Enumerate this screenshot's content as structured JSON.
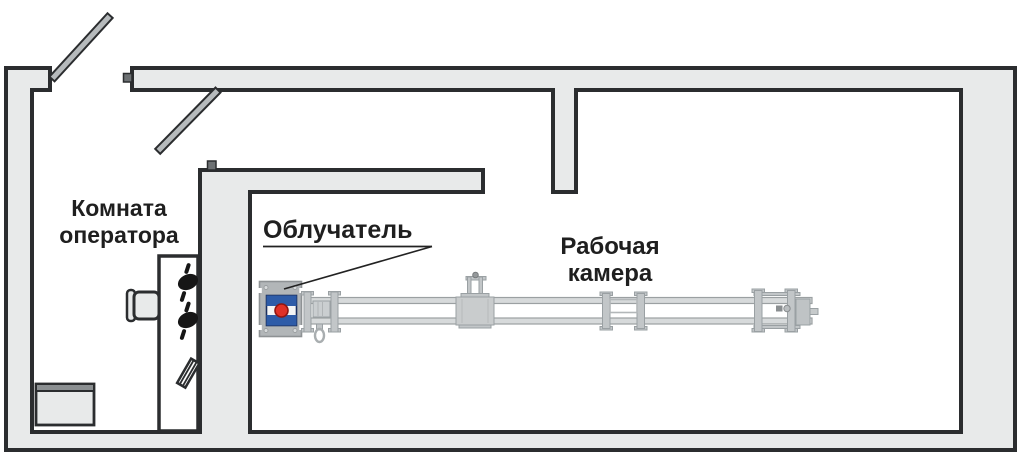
{
  "floor_plan": {
    "labels": {
      "operator_room": [
        "Комната",
        "оператора"
      ],
      "irradiator": "Облучатель",
      "working_chamber": [
        "Рабочая",
        "камера"
      ]
    },
    "colors": {
      "wall_fill": "#e8eaea",
      "outline": "#2b2d2f",
      "door_fill": "#b6babc",
      "machine_gray": "#c2c6c8",
      "irradiator_body": "#b2b6b8",
      "irradiator_blue": "#2e5ca8",
      "irradiator_red": "#e03127"
    }
  }
}
